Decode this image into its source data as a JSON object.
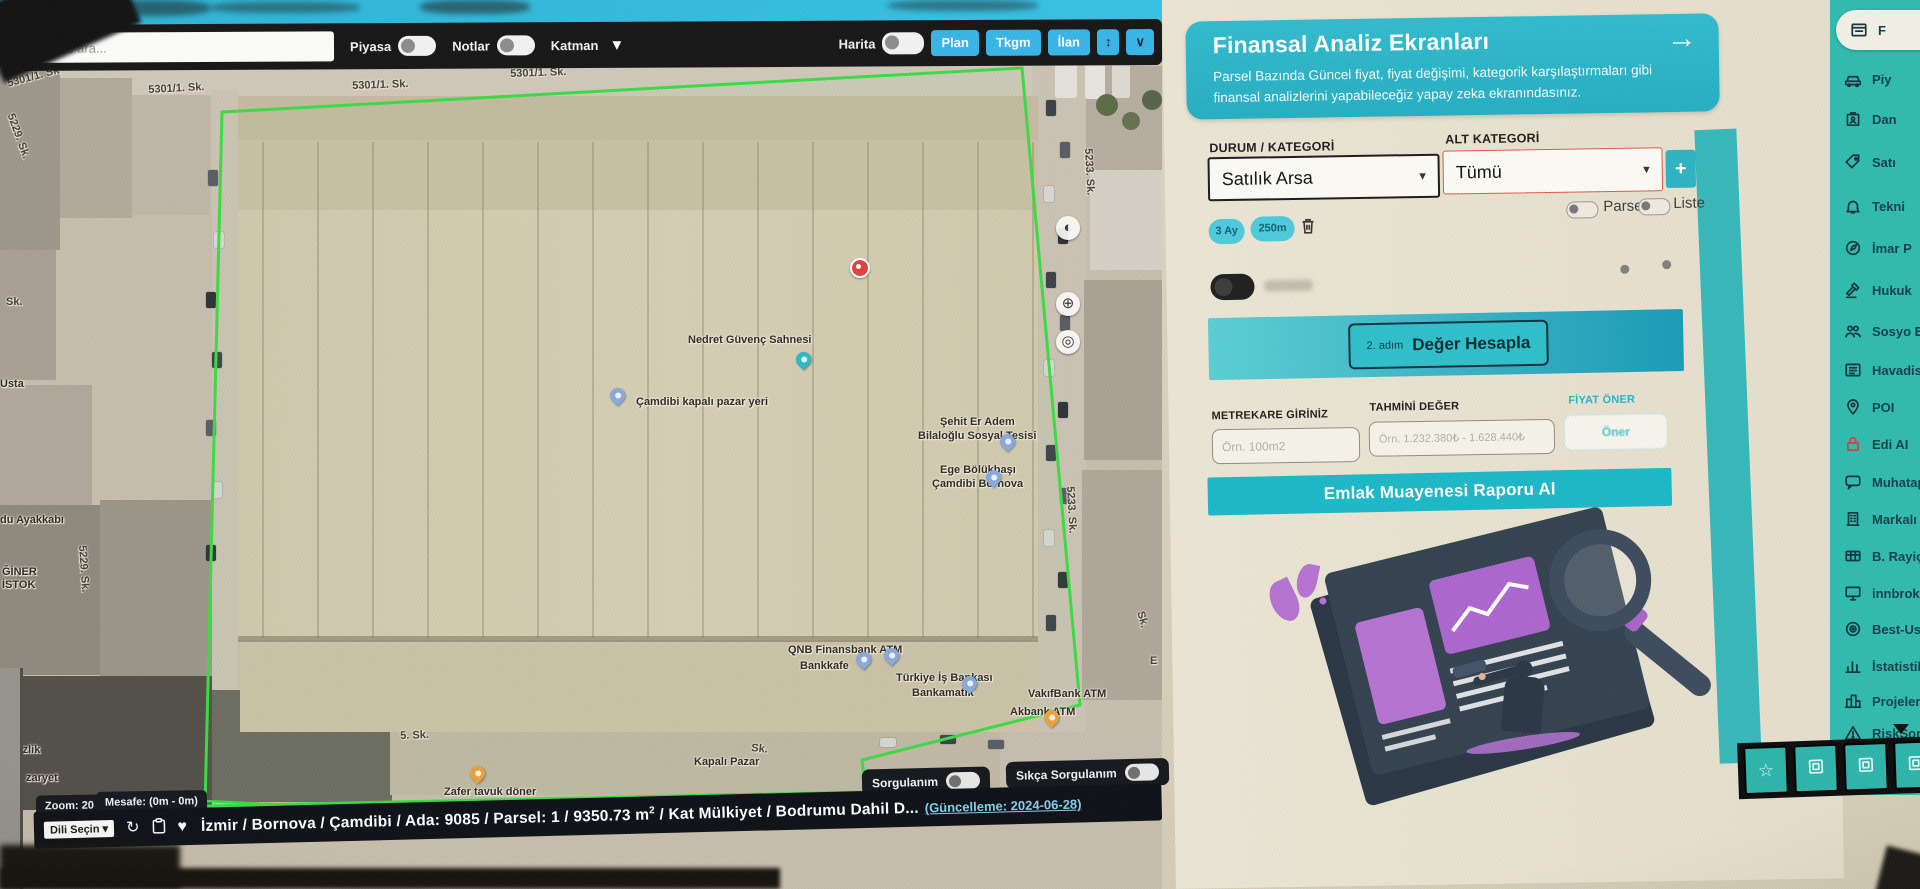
{
  "colors": {
    "accent_cyan": "#38b6e8",
    "card_teal": "#2cb7c8",
    "sidebar_teal": "#2fbcae",
    "button_teal": "#1cb9c8",
    "parcel_green": "#3ddb43",
    "bar_black": "#0d1116",
    "alert_border": "#e2574b"
  },
  "map_toolbar": {
    "search_placeholder": "mahalle ara...",
    "piyasa_label": "Piyasa",
    "notlar_label": "Notlar",
    "katman_label": "Katman",
    "harita_label": "Harita",
    "buttons": [
      {
        "label": "Plan"
      },
      {
        "label": "Tkgm"
      },
      {
        "label": "İlan"
      }
    ],
    "icons": {
      "swap_vertical": "↕",
      "chevron_down": "∨",
      "katman_caret": "▼"
    }
  },
  "map": {
    "street_labels": [
      {
        "text": "5301/1. Sk",
        "x": 6,
        "y": 78,
        "rot": -15
      },
      {
        "text": "5301/1. Sk.",
        "x": 148,
        "y": 84,
        "rot": -3
      },
      {
        "text": "5301/1. Sk.",
        "x": 352,
        "y": 80,
        "rot": -2
      },
      {
        "text": "5301/1. Sk.",
        "x": 510,
        "y": 68,
        "rot": -2
      },
      {
        "text": "5229. Sk.",
        "x": 16,
        "y": 112,
        "rot": 70
      },
      {
        "text": "5229. Sk.",
        "x": 88,
        "y": 545,
        "rot": 86
      },
      {
        "text": "5233. Sk.",
        "x": 1094,
        "y": 148,
        "rot": 87
      },
      {
        "text": "5233. Sk.",
        "x": 1076,
        "y": 486,
        "rot": 87
      },
      {
        "text": "Sk.",
        "x": 6,
        "y": 296,
        "rot": 0
      },
      {
        "text": "5. Sk.",
        "x": 400,
        "y": 730,
        "rot": -2
      },
      {
        "text": "Sk.",
        "x": 752,
        "y": 742,
        "rot": 6
      },
      {
        "text": "Sk.",
        "x": 1146,
        "y": 610,
        "rot": 75
      },
      {
        "text": "E",
        "x": 1150,
        "y": 655,
        "rot": 0
      }
    ],
    "poi_labels": [
      {
        "text": "Nedret Güvenç Sahnesi",
        "x": 688,
        "y": 334
      },
      {
        "text": "Çamdibi kapalı pazar yeri",
        "x": 636,
        "y": 396
      },
      {
        "text": "Şehit Er Adem",
        "x": 940,
        "y": 416
      },
      {
        "text": "Bilaloğlu Sosyal Tesisi",
        "x": 918,
        "y": 430
      },
      {
        "text": "Ege Bölükbaşı",
        "x": 940,
        "y": 464
      },
      {
        "text": "Çamdibi Bornova",
        "x": 932,
        "y": 478
      },
      {
        "text": "QNB Finansbank ATM",
        "x": 788,
        "y": 644
      },
      {
        "text": "Bankkafe",
        "x": 800,
        "y": 660
      },
      {
        "text": "Türkiye İş Bankası",
        "x": 896,
        "y": 672
      },
      {
        "text": "Bankamatik",
        "x": 912,
        "y": 687
      },
      {
        "text": "VakıfBank ATM",
        "x": 1028,
        "y": 688
      },
      {
        "text": "Akbank ATM",
        "x": 1010,
        "y": 706
      },
      {
        "text": "Kapalı Pazar",
        "x": 694,
        "y": 756
      },
      {
        "text": "Zafer tavuk döner",
        "x": 444,
        "y": 786
      },
      {
        "text": "temizlik",
        "x": 0,
        "y": 744
      },
      {
        "text": "zaryet",
        "x": 26,
        "y": 772
      },
      {
        "text": "Usta",
        "x": 0,
        "y": 378
      },
      {
        "text": "du Ayakkabı",
        "x": 0,
        "y": 514
      },
      {
        "text": "ĞİNER",
        "x": 2,
        "y": 566
      },
      {
        "text": "İSTOK",
        "x": 2,
        "y": 579
      }
    ],
    "pins": [
      {
        "type": "teal",
        "x": 796,
        "y": 352
      },
      {
        "type": "bl",
        "x": 610,
        "y": 388
      },
      {
        "type": "red",
        "x": 850,
        "y": 258
      },
      {
        "type": "bl",
        "x": 1000,
        "y": 434
      },
      {
        "type": "bl",
        "x": 986,
        "y": 470
      },
      {
        "type": "bl",
        "x": 856,
        "y": 652
      },
      {
        "type": "bl",
        "x": 884,
        "y": 648
      },
      {
        "type": "bl",
        "x": 962,
        "y": 676
      },
      {
        "type": "orange",
        "x": 1044,
        "y": 710
      },
      {
        "type": "orange",
        "x": 470,
        "y": 766
      }
    ],
    "controls": [
      {
        "glyph": "◐",
        "y": 216,
        "name": "compass-control"
      },
      {
        "glyph": "⊕",
        "y": 292,
        "name": "zoom-in-control"
      },
      {
        "glyph": "◎",
        "y": 330,
        "name": "locate-control"
      }
    ]
  },
  "bottom": {
    "zoom_chip": "Zoom: 20",
    "distance_chip": "Mesafe: (0m - 0m)",
    "sorgulanim_label": "Sorgulanım",
    "sikca_label": "Sıkça Sorgulanım",
    "language_label": "Dili Seçin",
    "icons": {
      "refresh": "↻",
      "heart": "♥",
      "caret": "▾"
    },
    "address_part1": "İzmir / Bornova / Çamdibi / Ada: 9085 / Parsel: 1 / 9350.73 m",
    "address_sup": "2",
    "address_part2": " / Kat Mülkiyet / Bodrumu Dahil D...",
    "address_update": "(Güncelleme: 2024-06-28)"
  },
  "panel": {
    "header": {
      "title": "Finansal Analiz Ekranları",
      "description": "Parsel Bazında Güncel fiyat, fiyat değişimi, kategorik karşılaştırmaları gibi finansal analizlerini yapabileceğiz yapay zeka ekranındasınız.",
      "arrow": "→"
    },
    "durum_label": "DURUM / KATEGORİ",
    "durum_value": "Satılık Arsa",
    "alt_label": "ALT KATEGORİ",
    "alt_value": "Tümü",
    "add_button": "+",
    "select_caret": "▾",
    "chips": [
      {
        "label": "3 Ay"
      },
      {
        "label": "250m"
      }
    ],
    "parsel_label": "Parsel",
    "liste_label": "Liste",
    "step_small": "2. adım",
    "step_label": "Değer Hesapla",
    "m2_label": "METREKARE GİRİNİZ",
    "m2_placeholder": "Örn. 100m2",
    "deger_label": "TAHMİNİ DEĞER",
    "deger_placeholder": "Örn. 1.232.380₺ - 1.628.440₺",
    "oner_label": "FİYAT ÖNER",
    "oner_button": "Öner",
    "report_button": "Emlak Muayenesi Raporu Al"
  },
  "sidebar": {
    "items": [
      {
        "label": "F",
        "icon": "finance-card-icon",
        "active": true
      },
      {
        "label": "Piy",
        "icon": "car-icon"
      },
      {
        "label": "Dan",
        "icon": "id-badge-icon"
      },
      {
        "label": "Satı",
        "icon": "sale-tag-icon"
      },
      {
        "label": "Tekni",
        "icon": "bell-icon"
      },
      {
        "label": "İmar P",
        "icon": "compass-icon"
      },
      {
        "label": "Hukuk",
        "icon": "gavel-icon"
      },
      {
        "label": "Sosyo E",
        "icon": "people-icon"
      },
      {
        "label": "Havadis",
        "icon": "news-icon"
      },
      {
        "label": "POI",
        "icon": "map-pin-icon"
      },
      {
        "label": "Edi AI",
        "icon": "lock-icon",
        "red": true
      },
      {
        "label": "Muhatap",
        "icon": "chat-icon"
      },
      {
        "label": "Markalı P.",
        "icon": "building-icon"
      },
      {
        "label": "B. Rayiçler",
        "icon": "grid-table-icon"
      },
      {
        "label": "innbroker",
        "icon": "monitor-icon"
      },
      {
        "label": "Best-Use",
        "icon": "target-icon"
      },
      {
        "label": "İstatistik",
        "icon": "bar-chart-icon"
      },
      {
        "label": "Projeler",
        "icon": "city-icon"
      },
      {
        "label": "RiskSor",
        "icon": "warning-icon"
      }
    ],
    "footer_buttons": [
      {
        "icon": "star-icon",
        "glyph": "☆"
      },
      {
        "icon": "frame-icon",
        "glyph": ""
      },
      {
        "icon": "frame-icon",
        "glyph": ""
      },
      {
        "icon": "frame-icon",
        "glyph": ""
      }
    ]
  }
}
